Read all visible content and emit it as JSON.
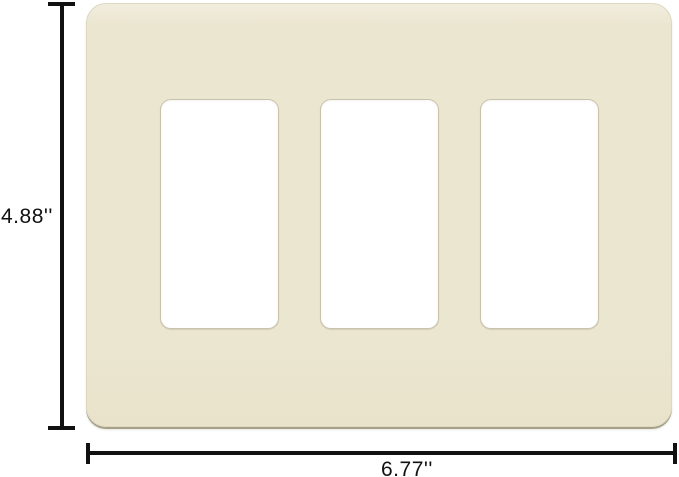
{
  "dimensions": {
    "height_label": "4.88''",
    "width_label": "6.77''"
  },
  "plate": {
    "cutout_count": 3
  },
  "colors": {
    "background": "#ffffff",
    "plate_fill": "#ebe6d0",
    "plate_fill_light": "#f1edde",
    "plate_fill_dark": "#e9e3cc",
    "plate_edge": "#a5a086",
    "plate_border": "#ded8c0",
    "cutout_fill": "#ffffff",
    "cutout_border": "#c9c3ab",
    "dimension_line": "#111111",
    "label_text": "#111111"
  }
}
